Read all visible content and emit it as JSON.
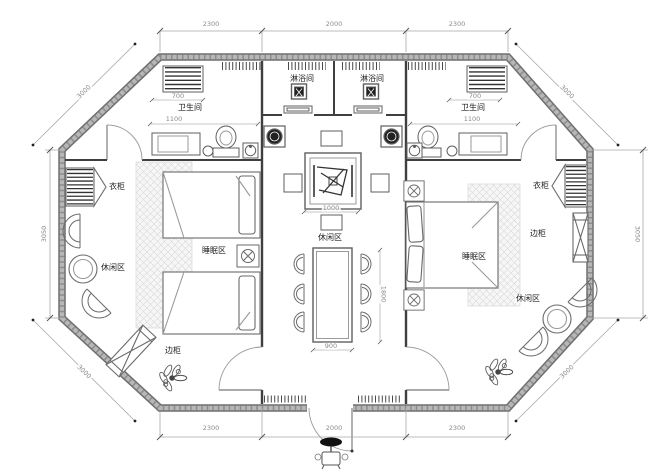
{
  "colors": {
    "wall": "#848484",
    "interior_line": "#4a4a4a",
    "furniture_line": "#6a6a6a",
    "dimension_line": "#aaaaaa",
    "hatch": "#d9d9d9",
    "label_text": "#222222",
    "dimension_text": "#8a8a8a"
  },
  "rooms": {
    "shower_left": "淋浴间",
    "shower_right": "淋浴间",
    "bathroom_left": "卫生间",
    "bathroom_right": "卫生间",
    "wardrobe_left": "衣柜",
    "wardrobe_right": "衣柜",
    "side_cabinet_left": "边柜",
    "side_cabinet_right": "边柜",
    "leisure_left": "休闲区",
    "leisure_center": "休闲区",
    "leisure_right": "休闲区",
    "sleeping_left": "睡眠区",
    "sleeping_right": "睡眠区"
  },
  "dimensions": {
    "top_left": "2300",
    "top_center": "2000",
    "top_right": "2300",
    "bottom_left": "2300",
    "bottom_center": "2000",
    "bottom_right": "2300",
    "side_left": "3050",
    "side_right": "3050",
    "diagonal_top_left": "3000",
    "diagonal_top_right": "3000",
    "diagonal_bottom_left": "3000",
    "diagonal_bottom_right": "3000",
    "bath_left_width": "1100",
    "bath_right_width": "1100",
    "closet_left_width": "700",
    "closet_right_width": "700",
    "tea_table_width": "1000",
    "dining_table_width": "900",
    "dining_table_length": "1800"
  }
}
